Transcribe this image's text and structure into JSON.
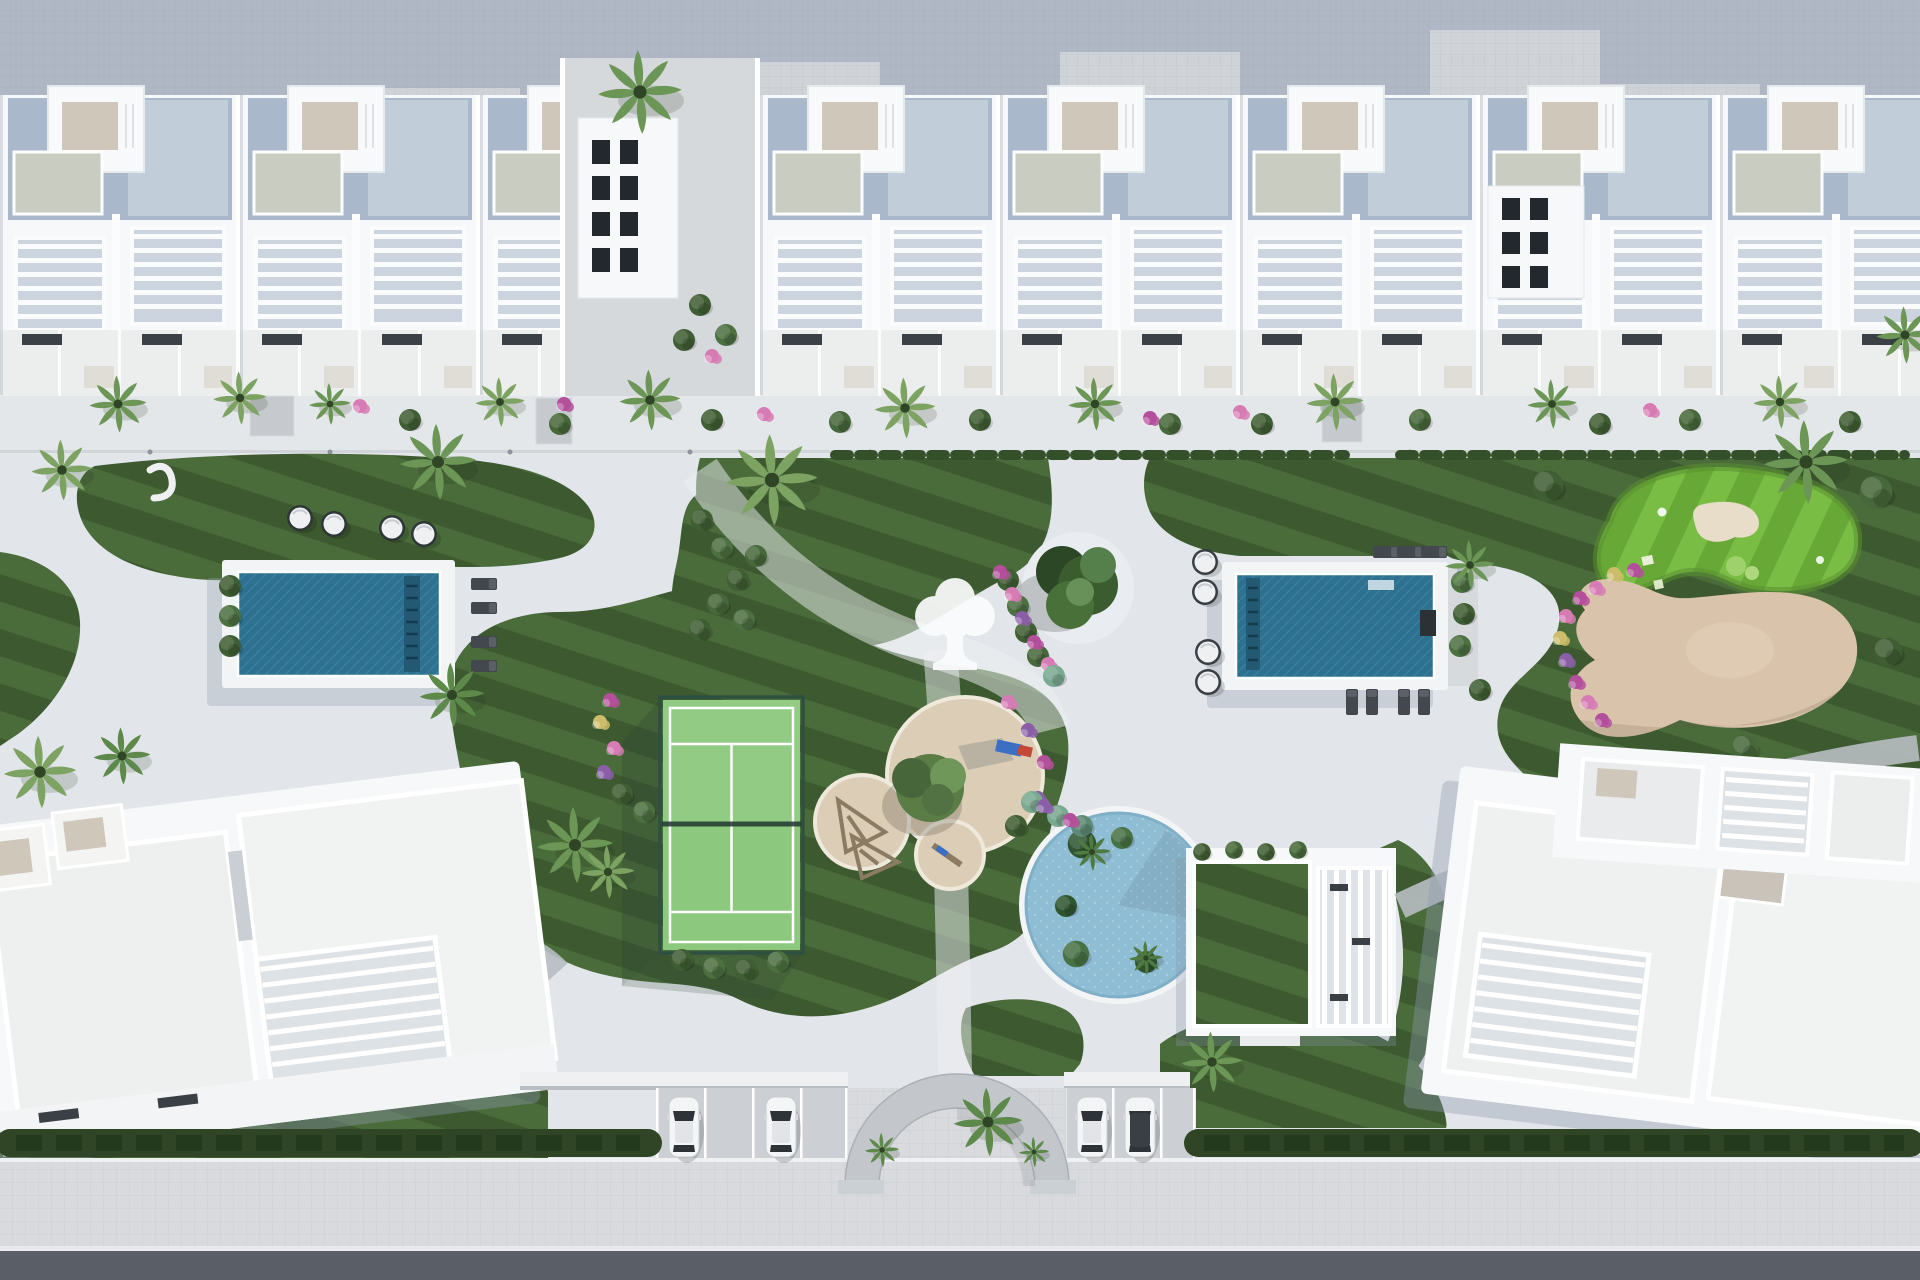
{
  "meta": {
    "title": "Aerial top-down 3D render of a residential resort masterplan",
    "visible_text": []
  },
  "palette": {
    "paving_light": "#e2e5e9",
    "paving_top": "#cfd2d6",
    "paving_mid": "#d8dadd",
    "road_asphalt": "#5a5e66",
    "shadow_blue": "#8d9bb0",
    "building_white": "#f7f8fa",
    "roof_blue_grey": "#a9b9cb",
    "roof_panel_light": "#c6d0da",
    "roof_beige": "#cfc8ba",
    "canopy_sage": "#c8ccc1",
    "solar_dark": "#3a4046",
    "lawn_dark": "#3c5930",
    "lawn_light": "#4a6b3a",
    "golf_dark": "#67a836",
    "golf_light": "#79bd45",
    "court_green": "#8cc87d",
    "court_fence": "#2e5041",
    "pool_water": "#2d7090",
    "pool_water_line": "#3d87a5",
    "lagoon_water": "#8fbdd3",
    "sand_play": "#dccdb7",
    "sand_bunker": "#d9c4ab",
    "bunker_inner": "#e8ddc8",
    "green_bush": "#3f5e33",
    "teal_bush": "#79a98f",
    "palm_green": "#6b9655",
    "flower_magenta": "#b44f9b",
    "flower_pink": "#d77bb4",
    "flower_yellow": "#cdbd6a",
    "flower_purple": "#8b5fa8",
    "hedge_dark": "#2f4526",
    "deck_white": "#f3f4f6",
    "arch_grey": "#c3c7cc",
    "car_glass": "#2e3338",
    "lounger_grey": "#43484e",
    "logo_white": "#fbfcfd"
  },
  "scene": {
    "view": "top-down aerial",
    "top_row": {
      "type": "townhouse-row",
      "units": 8,
      "features": [
        "blue-grey roof decks",
        "white pergola grids",
        "penthouse stairs",
        "solar panels"
      ]
    },
    "park": {
      "lap_pools": 2,
      "lagoon_pool": 1,
      "padel_court": 1,
      "putting_green": 1,
      "sand_bunker": 1,
      "playground_sand_circles": 3,
      "round_daybeds": 8,
      "sun_loungers": 11,
      "tree_logo_on_paving": 1
    },
    "bottom": {
      "apartment_blocks": 2,
      "clubhouse_green_roof": 1,
      "entrance_arch": 1,
      "parked_cars": 4,
      "hedge_bands": 2,
      "road": "asphalt"
    }
  }
}
